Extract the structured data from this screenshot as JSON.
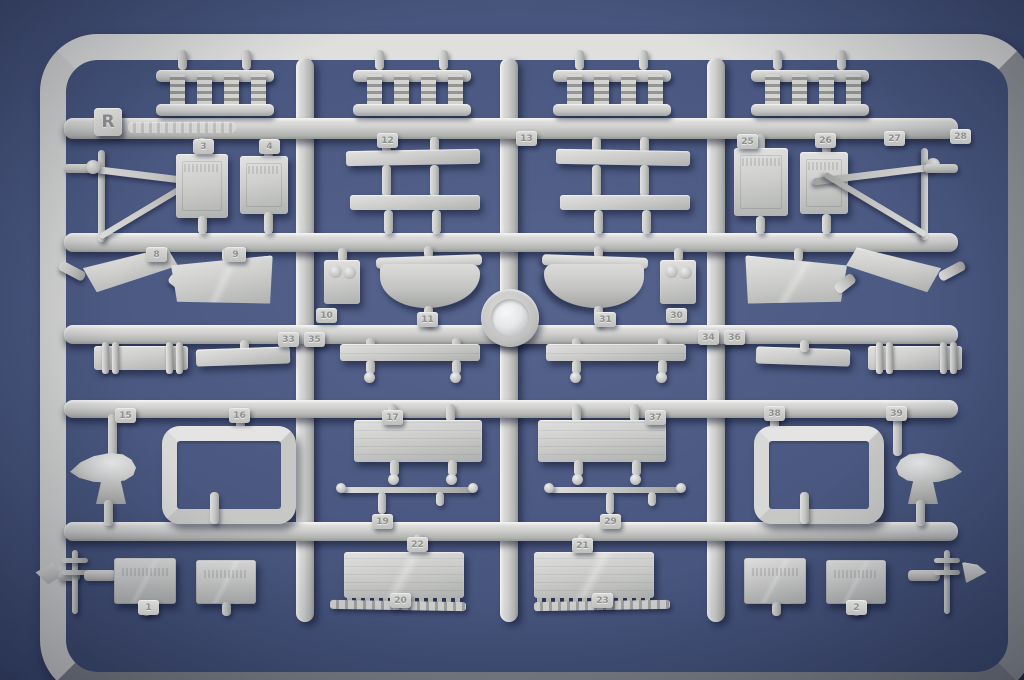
{
  "scene": {
    "type": "photograph",
    "description": "Light-grey injection-moulded plastic sprue (parts runner) of a warship model kit lying on a blue-grey surface",
    "subject": "model kit sprue",
    "background_color": "#4a5881",
    "plastic_color": "#c9cac8"
  },
  "sprue": {
    "letter_tag": "R"
  },
  "chips": [
    {
      "label": "3"
    },
    {
      "label": "4"
    },
    {
      "label": "12"
    },
    {
      "label": "13"
    },
    {
      "label": "25"
    },
    {
      "label": "26"
    },
    {
      "label": "27"
    },
    {
      "label": "28"
    },
    {
      "label": "8"
    },
    {
      "label": "9"
    },
    {
      "label": "10"
    },
    {
      "label": "11"
    },
    {
      "label": "31"
    },
    {
      "label": "30"
    },
    {
      "label": "33"
    },
    {
      "label": "35"
    },
    {
      "label": "34"
    },
    {
      "label": "36"
    },
    {
      "label": "15"
    },
    {
      "label": "16"
    },
    {
      "label": "17"
    },
    {
      "label": "37"
    },
    {
      "label": "38"
    },
    {
      "label": "39"
    },
    {
      "label": "19"
    },
    {
      "label": "29"
    },
    {
      "label": "22"
    },
    {
      "label": "21"
    },
    {
      "label": "1"
    },
    {
      "label": "20"
    },
    {
      "label": "23"
    },
    {
      "label": "2"
    }
  ]
}
